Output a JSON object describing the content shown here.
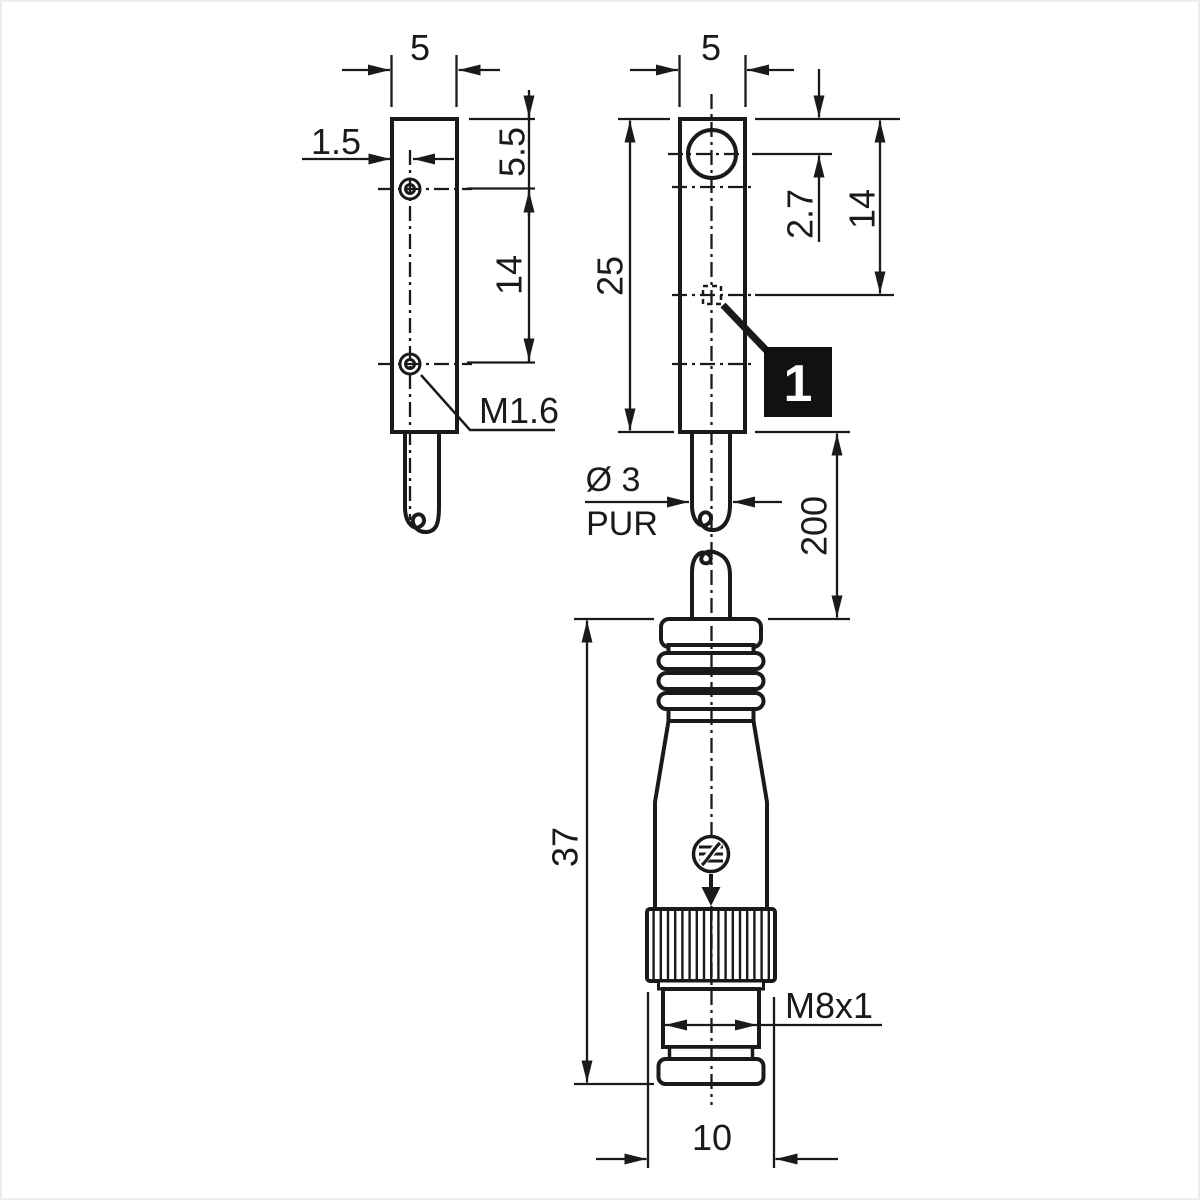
{
  "drawing": {
    "side_view": {
      "width": "5",
      "hole_offset": "1.5",
      "hole_top_distance": "5.5",
      "hole_spacing": "14",
      "screw_thread": "M1.6"
    },
    "front_view": {
      "width": "5",
      "body_length": "25",
      "face_offset": "2.7",
      "led_offset": "14"
    },
    "cable": {
      "diameter": "Ø 3",
      "material": "PUR",
      "length": "200"
    },
    "connector": {
      "length": "37",
      "thread": "M8x1",
      "nut_width": "10"
    },
    "callout": {
      "label": "1"
    },
    "colors": {
      "line": "#1a1a1a",
      "background": "#ffffff",
      "callout_bg": "#111111"
    }
  }
}
